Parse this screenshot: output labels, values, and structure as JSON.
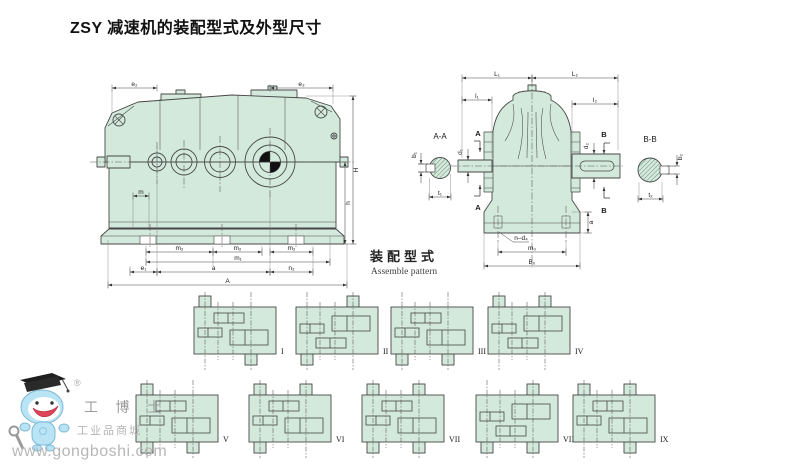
{
  "page": {
    "title": "ZSY 减速机的装配型式及外型尺寸"
  },
  "colors": {
    "housing_fill": "#d3e9dc",
    "line": "#474747",
    "dim_line": "#444444",
    "watermark_gray": "#b0b0b0",
    "mascot_blue": "#b9e4f6",
    "mouth_red": "#dd4457"
  },
  "side_view": {
    "dims": {
      "e2": "e₂",
      "e3": "e₃",
      "H": "H",
      "h": "h",
      "m": "m",
      "m2a": "m₂",
      "m2b": "m₂",
      "m2c": "m₂",
      "m1": "m₁",
      "e1": "e₁",
      "a": "a",
      "n2": "n₂",
      "A": "A"
    }
  },
  "section_aa": {
    "label": "A-A",
    "dims": {
      "b1": "b₁",
      "t1": "t₁"
    }
  },
  "section_bb": {
    "label": "B-B",
    "dims": {
      "b2": "b₂",
      "t2": "t₂"
    }
  },
  "front_view": {
    "dims": {
      "L1": "L₁",
      "L2": "L₂",
      "l1": "l₁",
      "l2": "l₂",
      "d1": "d₁",
      "d2": "d₂",
      "A_section": "A",
      "B_section": "B",
      "n_d4": "n–d₄",
      "m0": "m₀",
      "B0": "B₀",
      "a": "a"
    }
  },
  "assemble": {
    "title_zh": "装配型式",
    "title_en": "Assemble pattern",
    "patterns": [
      {
        "numeral": "I",
        "stubs": [
          "tl",
          "br"
        ]
      },
      {
        "numeral": "II",
        "stubs": [
          "bl",
          "tr"
        ],
        "flip": true
      },
      {
        "numeral": "III",
        "stubs": [
          "bl",
          "br"
        ]
      },
      {
        "numeral": "IV",
        "stubs": [
          "tl",
          "tr"
        ],
        "flip": true
      },
      {
        "numeral": "V",
        "stubs": [
          "tl",
          "bl",
          "br"
        ]
      },
      {
        "numeral": "VI",
        "stubs": [
          "tl",
          "bl",
          "tr"
        ]
      },
      {
        "numeral": "VII",
        "stubs": [
          "tl",
          "bl",
          "tr",
          "br"
        ]
      },
      {
        "numeral": "VIII",
        "stubs": [
          "tr",
          "bl",
          "br"
        ],
        "flip": true
      },
      {
        "numeral": "IX",
        "stubs": [
          "tl",
          "tr",
          "br"
        ]
      }
    ]
  },
  "watermark": {
    "registered": "®",
    "brand": "工 博 士",
    "tagline": "工业品商城",
    "url": "www.gongboshi.com"
  }
}
